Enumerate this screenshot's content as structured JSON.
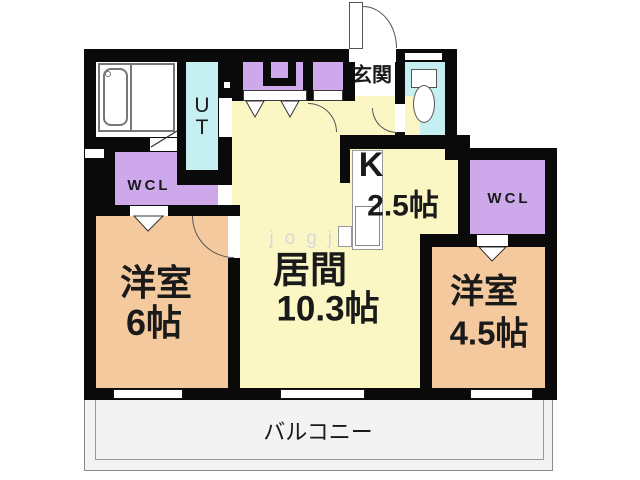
{
  "plan_title": "2LDK apartment floor plan",
  "rooms": {
    "entrance": {
      "label": "玄関"
    },
    "utility": {
      "label": "UT",
      "line1": "U",
      "line2": "T"
    },
    "wcl_left": {
      "label": "WCL"
    },
    "wcl_right": {
      "label": "WCL"
    },
    "kitchen": {
      "label": "K",
      "area": "2.5帖"
    },
    "living": {
      "label": "居間",
      "area": "10.3帖"
    },
    "western_left": {
      "label": "洋室",
      "area": "6帖"
    },
    "western_right": {
      "label": "洋室",
      "area": "4.5帖"
    },
    "balcony": {
      "label": "バルコニー"
    }
  },
  "fixtures": {
    "bathtub": "unit-bath with tub",
    "toilet": "toilet bowl and tank",
    "kitchen_counter": "kitchen counter / sink"
  },
  "watermark": "jogjo",
  "colors": {
    "wall": "#0a0a0a",
    "yellow": "#faf7c5",
    "orange": "#f5c99e",
    "purple": "#cda9eb",
    "cyan": "#c6eff2",
    "balcony": "#f3f3f3",
    "text": "#1a1a1a",
    "watermark": "#d8d8d8"
  }
}
